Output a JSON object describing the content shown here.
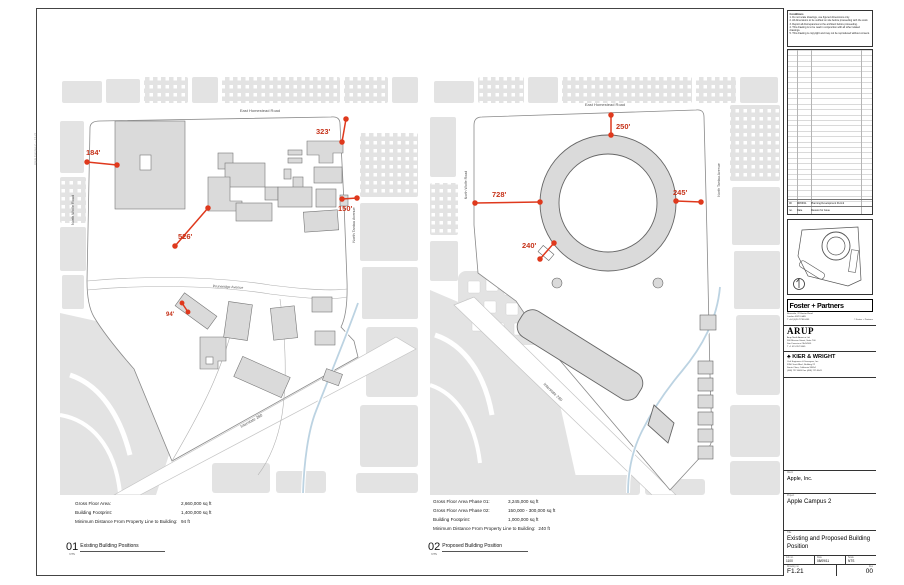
{
  "panel_left": {
    "number": "01",
    "scale_note": "NTS",
    "title": "Existing Building Positions",
    "roads": {
      "homestead": "East Homestead Road",
      "wolfe": "North Wolfe Road",
      "tantau": "North Tantau Avenue",
      "pruneridge": "Pruneridge Avenue",
      "i280": "Interstate 280"
    },
    "dims": {
      "d184": "184'",
      "d323": "323'",
      "d150": "150'",
      "d526": "526'",
      "d94": "94'"
    },
    "stats": [
      {
        "label": "Gross Floor Area:",
        "value": "2,660,000 sq ft"
      },
      {
        "label": "Building Footprint:",
        "value": "1,400,000 sq ft"
      },
      {
        "label": "Minimum Distance From Property Line to Building:",
        "value": "94 ft"
      }
    ]
  },
  "panel_right": {
    "number": "02",
    "scale_note": "NTS",
    "title": "Proposed Building Position",
    "roads": {
      "homestead": "East Homestead Road",
      "wolfe": "North Wolfe Road",
      "tantau": "North Tantau Avenue",
      "i280": "Interstate 280"
    },
    "dims": {
      "d250": "250'",
      "d728": "728'",
      "d245": "245'",
      "d240": "240'"
    },
    "stats": [
      {
        "label": "Gross Floor Area Phase 01:",
        "value": "3,245,000 sq ft"
      },
      {
        "label": "Gross Floor Area Phase 02:",
        "value": "150,000 - 300,000 sq ft"
      },
      {
        "label": "Building Footprint:",
        "value": "1,000,000 sq ft"
      },
      {
        "label": "Minimum Distance From Property Line to Building:",
        "value": "240 ft"
      }
    ]
  },
  "titleblock": {
    "notes_title": "Conditions",
    "notes": [
      "1. Do not scale drawings, use figured dimensions only.",
      "2. All dimensions to be verified on site before proceeding with the work.",
      "3. Report all discrepancies to the architect before proceeding.",
      "4. This drawing is to be read in conjunction with all other related drawings.",
      "5. This drawing is copyright and may not be reproduced without consent."
    ],
    "revision_row": {
      "rev": "00",
      "date": "08/09/11",
      "reason": "Planning Development Permit"
    },
    "revision_header": {
      "rev": "no.",
      "date": "Date",
      "reason": "Reason for Issue"
    },
    "foster": {
      "name": "Foster + Partners",
      "addr1": "Riverside, 22 Hester Road",
      "addr2": "London SW11 4AN",
      "addr3": "T +44 (0)20 7738 0455",
      "copyright": "© Foster + Partners"
    },
    "arup": {
      "name": "ARUP",
      "addr1": "Arup North America Ltd",
      "addr2": "560 Mission Street, Suite 700",
      "addr3": "San Francisco CA 94105",
      "addr4": "T +1 415 957 9445"
    },
    "kierwright": {
      "tree": "♣",
      "name": "KIER & WRIGHT",
      "addr1": "Civil Engineers & Surveyors, Inc.",
      "addr2": "3350 Scott Blvd., Building 22",
      "addr3": "Santa Clara, California 95054",
      "addr4": "(408) 727-6665    Fax (408) 727-5641"
    },
    "client_label": "Client",
    "client": "Apple, Inc.",
    "project_label": "Project",
    "project": "Apple Campus 2",
    "sheet_title_label": "Title",
    "sheet_title": "Existing and Proposed Building Position",
    "job_label": "Job no.",
    "job": "1100",
    "date_label": "Date",
    "date": "08/09/11",
    "scale_label": "Scale",
    "scale": "NTS",
    "dwg_label": "Drawing no.",
    "dwg": "F1.21",
    "rev_label": "Rev",
    "rev": "00"
  },
  "stamp": "Apple Campus 2 — F1.21"
}
